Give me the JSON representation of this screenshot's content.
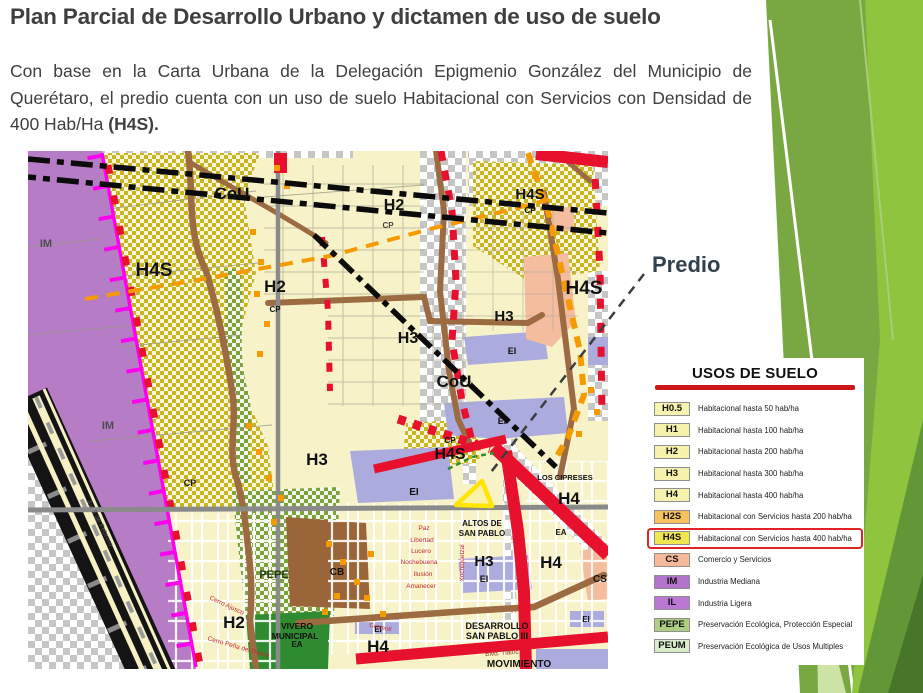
{
  "slide": {
    "title": "Plan Parcial de Desarrollo Urbano y dictamen de uso de suelo",
    "body_before": "Con base en la Carta Urbana de la Delegación Epigmenio González del Municipio de Querétaro, el predio cuenta con un uso de suelo Habitacional con Servicios con Densidad de 400 Hab/Ha ",
    "body_bold": "(H4S).",
    "title_color": "#3F3F3F",
    "decoration_greens": [
      "#8FC43F",
      "#79A843",
      "#639636",
      "#47762A",
      "#CDE3A5"
    ]
  },
  "annotation": {
    "predio_label": "Predio",
    "pointer_color": "#3D3D3D",
    "marker_color": "#FFE500"
  },
  "legend": {
    "title": "USOS DE SUELO",
    "accent_color": "#CC1719",
    "highlight_code": "H4S",
    "highlight_color": "#E02424",
    "items": [
      {
        "code": "H0.5",
        "label": "Habitacional hasta 50 hab/ha",
        "color": "#F7F2AE"
      },
      {
        "code": "H1",
        "label": "Habitacional hasta 100 hab/ha",
        "color": "#F7F2AE"
      },
      {
        "code": "H2",
        "label": "Habitacional hasta 200 hab/ha",
        "color": "#F7F2AE"
      },
      {
        "code": "H3",
        "label": "Habitacional hasta 300 hab/ha",
        "color": "#F7F2AE"
      },
      {
        "code": "H4",
        "label": "Habitacional hasta 400 hab/ha",
        "color": "#F7F2AE"
      },
      {
        "code": "H2S",
        "label": "Habitacional con Servicios hasta 200 hab/ha",
        "color": "#F6C25E"
      },
      {
        "code": "H4S",
        "label": "Habitacional con Servicios hasta 400 hab/ha",
        "color": "#EFE74B"
      },
      {
        "code": "CS",
        "label": "Comercio y Servicios",
        "color": "#F8B99A"
      },
      {
        "code": "IM",
        "label": "Industria Mediana",
        "color": "#B473CB"
      },
      {
        "code": "IL",
        "label": "Industria Ligera",
        "color": "#BB78D2"
      },
      {
        "code": "PEPE",
        "label": "Preservación Ecológica, Protección Especial",
        "color": "#AECE84"
      },
      {
        "code": "PEUM",
        "label": "Preservación Ecológica de Usos Multiples",
        "color": "#D8EECC"
      }
    ]
  },
  "map": {
    "colors": {
      "base": "#F8F2C8",
      "industry_purple": "#B77CC6",
      "checker_olive": "#C9B327",
      "checker_green": "#7CA23F",
      "lavender": "#ABABDE",
      "salmon": "#F4BD9E",
      "road_brown": "#9C6B42",
      "road_red": "#E8112D",
      "boundary_magenta": "#FF00EE",
      "road_orange": "#F59A00",
      "vivero_green": "#2E8B2F",
      "cb_brown": "#9A6538",
      "highway_black": "#141414",
      "transparency_checker": "#C6C6C6",
      "section_gray": "#8A8A8A"
    },
    "labels": [
      {
        "t": "CoU",
        "x": 204,
        "y": 48,
        "s": 17
      },
      {
        "t": "H2",
        "x": 247,
        "y": 141,
        "s": 17
      },
      {
        "t": "CP",
        "x": 247,
        "y": 161,
        "s": 8
      },
      {
        "t": "IM",
        "x": 18,
        "y": 96,
        "s": 11,
        "c": "#4d4d4d"
      },
      {
        "t": "H4S",
        "x": 126,
        "y": 125,
        "s": 19
      },
      {
        "t": "CP",
        "x": 162,
        "y": 335,
        "s": 9
      },
      {
        "t": "IM",
        "x": 80,
        "y": 278,
        "s": 11,
        "c": "#4d4d4d"
      },
      {
        "t": "H2",
        "x": 366,
        "y": 59,
        "s": 16
      },
      {
        "t": "CP",
        "x": 360,
        "y": 77,
        "s": 8,
        "c": "#444444"
      },
      {
        "t": "H4S",
        "x": 502,
        "y": 48,
        "s": 15
      },
      {
        "t": "CP",
        "x": 502,
        "y": 62,
        "s": 8
      },
      {
        "t": "H4S",
        "x": 556,
        "y": 143,
        "s": 19
      },
      {
        "t": "H3",
        "x": 380,
        "y": 192,
        "s": 16
      },
      {
        "t": "H3",
        "x": 476,
        "y": 170,
        "s": 15
      },
      {
        "t": "CoU",
        "x": 426,
        "y": 236,
        "s": 17
      },
      {
        "t": "EI",
        "x": 484,
        "y": 203,
        "s": 9
      },
      {
        "t": "EI",
        "x": 474,
        "y": 273,
        "s": 9
      },
      {
        "t": "EI",
        "x": 386,
        "y": 344,
        "s": 10
      },
      {
        "t": "H3",
        "x": 289,
        "y": 314,
        "s": 17
      },
      {
        "t": "CP",
        "x": 422,
        "y": 292,
        "s": 8
      },
      {
        "t": "H4S",
        "x": 422,
        "y": 308,
        "s": 16
      },
      {
        "t": "LOS CIPRESES",
        "x": 537,
        "y": 329,
        "s": 7.5
      },
      {
        "t": "H4",
        "x": 541,
        "y": 353,
        "s": 17
      },
      {
        "t": "ALTOS DE",
        "x": 454,
        "y": 375,
        "s": 8,
        "w": 700
      },
      {
        "t": "SAN PABLO",
        "x": 454,
        "y": 385,
        "s": 8,
        "w": 700
      },
      {
        "t": "EA",
        "x": 533,
        "y": 384,
        "s": 8
      },
      {
        "t": "H3",
        "x": 456,
        "y": 415,
        "s": 15
      },
      {
        "t": "EI",
        "x": 456,
        "y": 431,
        "s": 9
      },
      {
        "t": "H4",
        "x": 523,
        "y": 417,
        "s": 17
      },
      {
        "t": "CS",
        "x": 572,
        "y": 431,
        "s": 10
      },
      {
        "t": "CB",
        "x": 309,
        "y": 424,
        "s": 10
      },
      {
        "t": "PEPE",
        "x": 246,
        "y": 427,
        "s": 11,
        "w": 700,
        "c": "#223B10"
      },
      {
        "t": "H2",
        "x": 206,
        "y": 477,
        "s": 17
      },
      {
        "t": "VIVERO",
        "x": 269,
        "y": 478,
        "s": 8.5,
        "w": 700
      },
      {
        "t": "MUNICIPAL",
        "x": 267,
        "y": 488,
        "s": 8.5,
        "w": 700
      },
      {
        "t": "EA",
        "x": 269,
        "y": 496,
        "s": 8,
        "w": 700
      },
      {
        "t": "H4",
        "x": 350,
        "y": 501,
        "s": 17
      },
      {
        "t": "DESARROLLO",
        "x": 469,
        "y": 478,
        "s": 9,
        "w": 700
      },
      {
        "t": "SAN PABLO III",
        "x": 469,
        "y": 488,
        "s": 9,
        "w": 700
      },
      {
        "t": "MOVIMIENTO",
        "x": 491,
        "y": 516,
        "s": 10,
        "w": 700
      },
      {
        "t": "EI",
        "x": 350,
        "y": 481,
        "s": 8
      },
      {
        "t": "EI",
        "x": 558,
        "y": 471,
        "s": 8
      },
      {
        "t": "Paz",
        "x": 396,
        "y": 379,
        "s": 6.5,
        "w": 400,
        "c": "#C42B2B"
      },
      {
        "t": "Libertad",
        "x": 394,
        "y": 391,
        "s": 6.5,
        "w": 400,
        "c": "#C42B2B"
      },
      {
        "t": "Lucero",
        "x": 393,
        "y": 402,
        "s": 6.5,
        "w": 400,
        "c": "#C42B2B"
      },
      {
        "t": "Nochebuena",
        "x": 391,
        "y": 413,
        "s": 6.5,
        "w": 400,
        "c": "#C42B2B"
      },
      {
        "t": "Ilusión",
        "x": 395,
        "y": 425,
        "s": 6.5,
        "w": 400,
        "c": "#C42B2B"
      },
      {
        "t": "Amanecer",
        "x": 393,
        "y": 437,
        "s": 6.5,
        "w": 400,
        "c": "#C42B2B"
      },
      {
        "t": "Xochiquetzal",
        "x": 436,
        "y": 412,
        "s": 6.5,
        "w": 400,
        "c": "#C42B2B",
        "r": -90
      },
      {
        "t": "Cerro Ajusco",
        "x": 198,
        "y": 456,
        "s": 6.5,
        "w": 400,
        "c": "#C42B2B",
        "r": 25
      },
      {
        "t": "Cerro Peña del Diablo",
        "x": 210,
        "y": 498,
        "s": 6.5,
        "w": 400,
        "c": "#C42B2B",
        "r": 16
      },
      {
        "t": "Blvd. Tlaloc",
        "x": 474,
        "y": 504,
        "s": 6.5,
        "w": 400,
        "c": "#8A3A10",
        "r": -4
      },
      {
        "t": "Centeotl",
        "x": 352,
        "y": 478,
        "s": 6,
        "w": 400,
        "c": "#C42B2B",
        "r": 12
      },
      {
        "t": "Av. 5 de Febrero",
        "x": 70,
        "y": 373,
        "s": 7,
        "w": 400,
        "c": "#555555",
        "r": 63
      }
    ]
  }
}
